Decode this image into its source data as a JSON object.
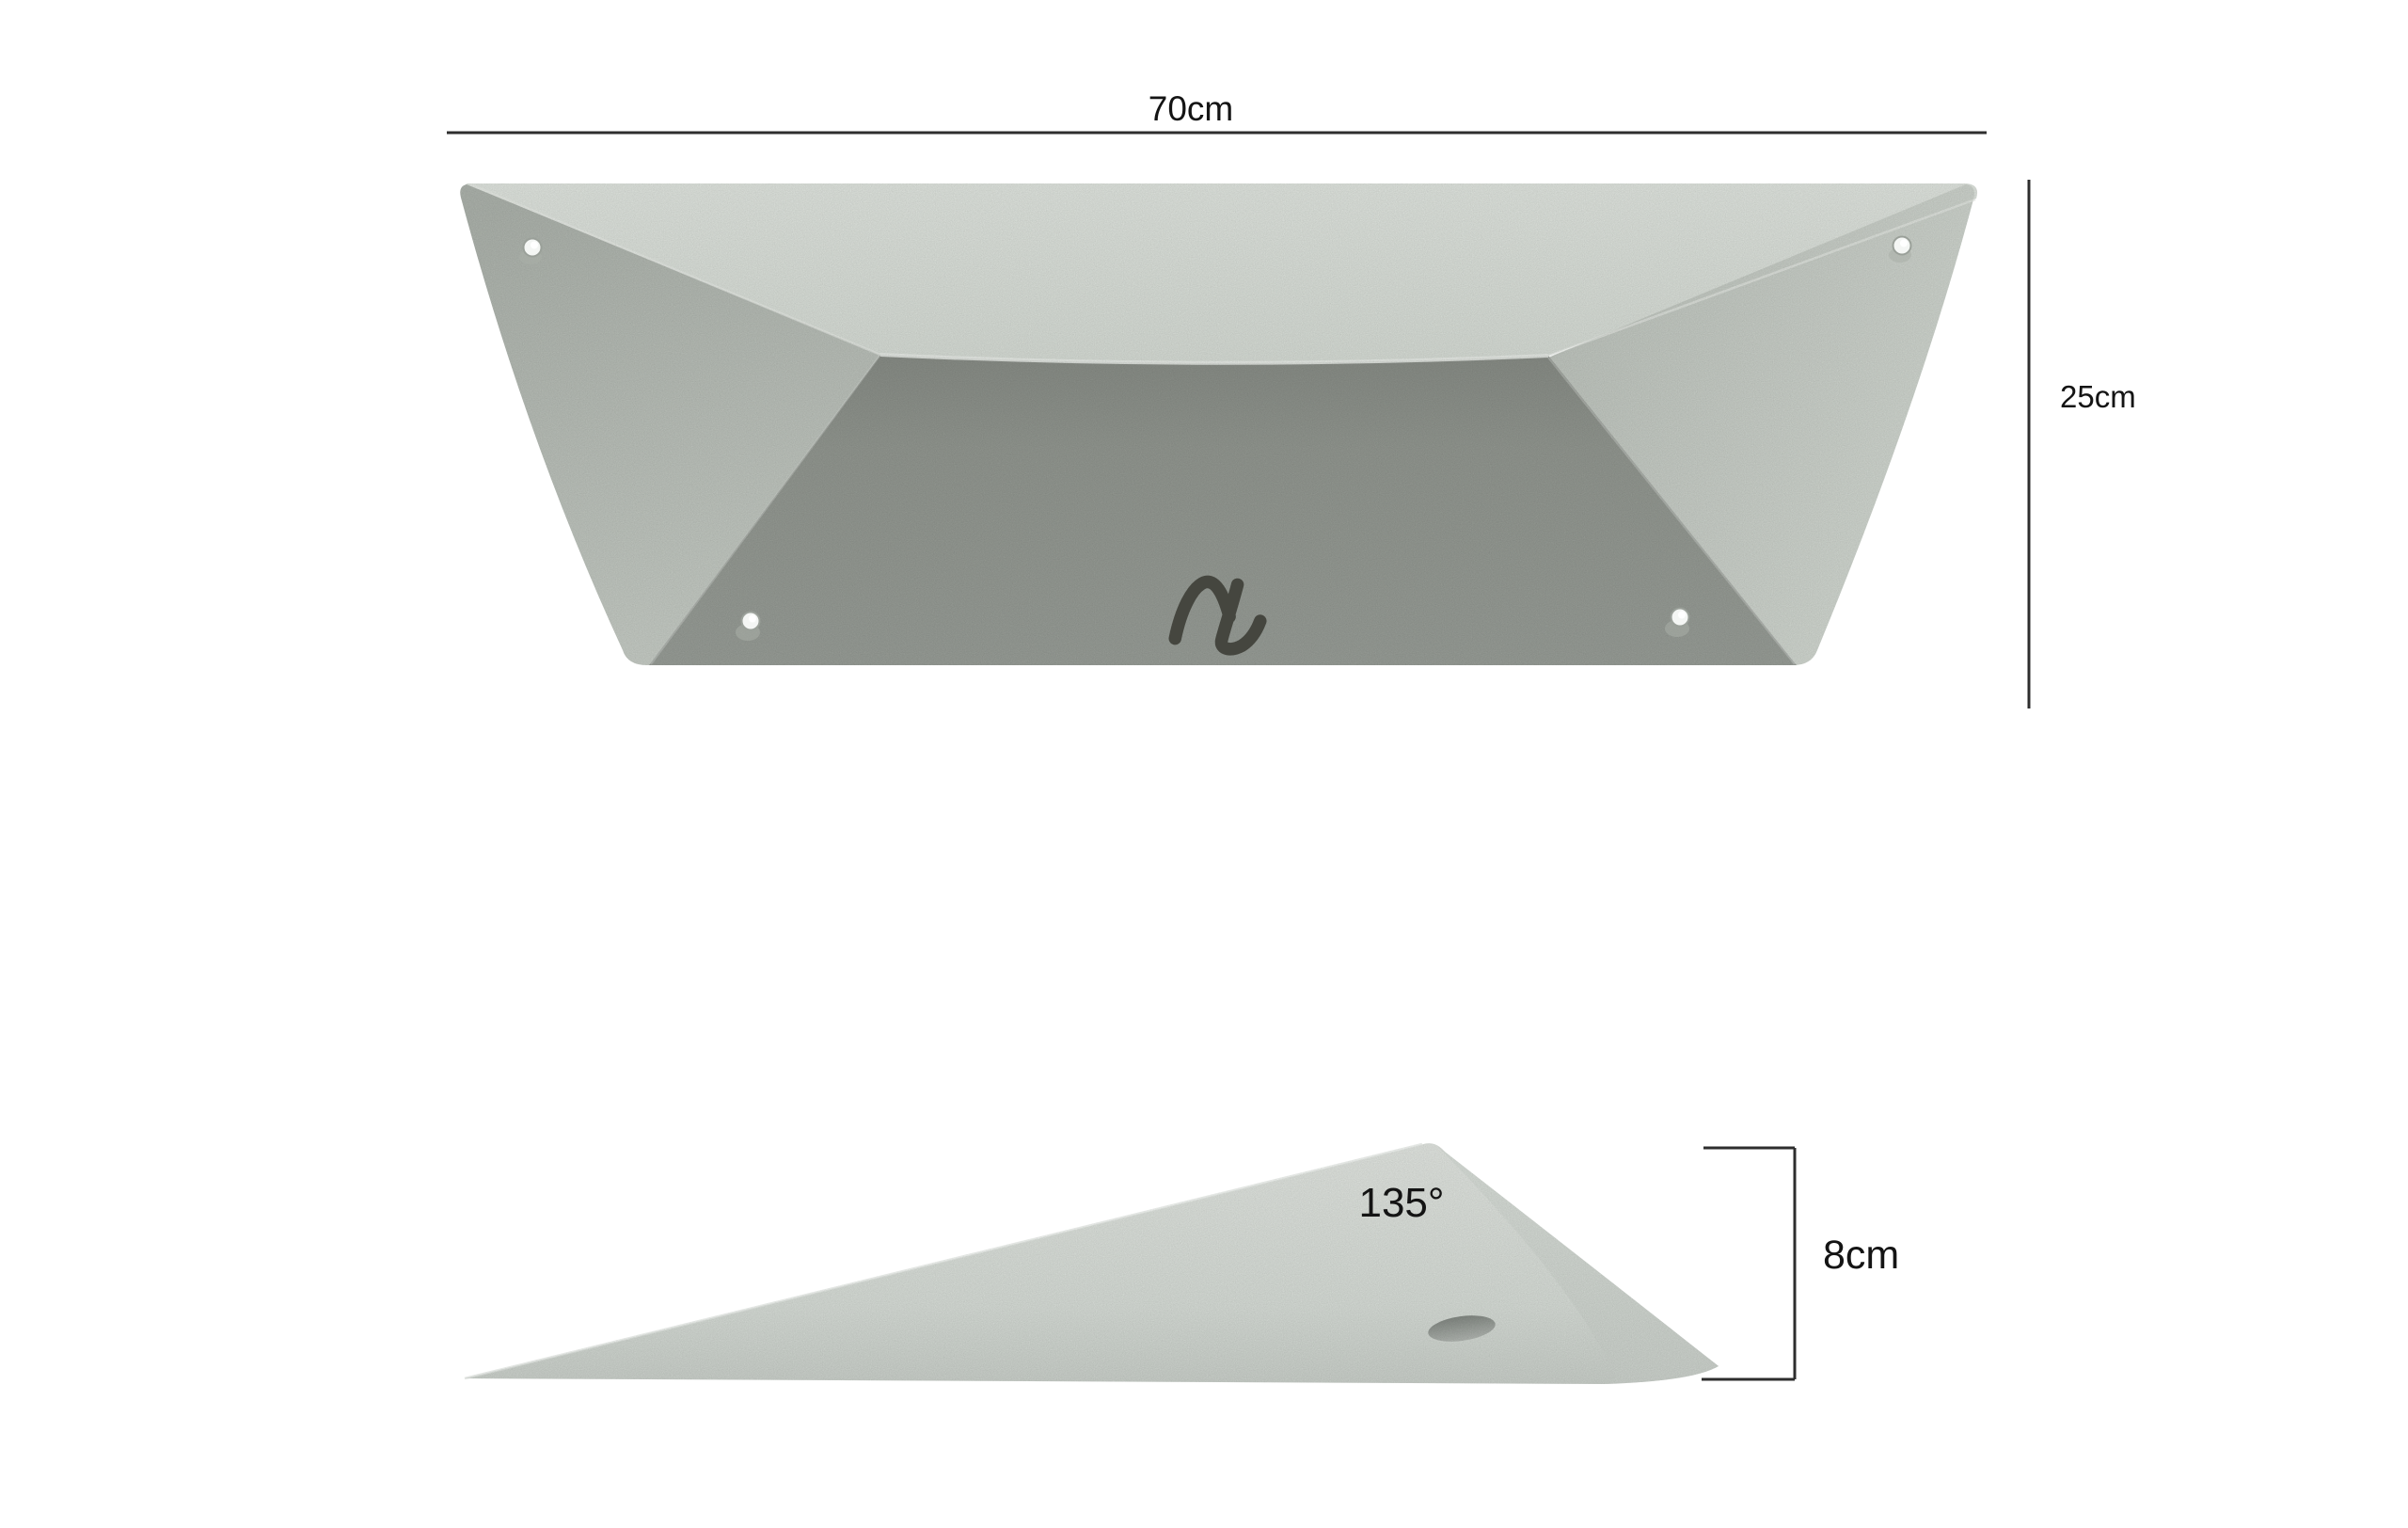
{
  "diagram": {
    "front_view": {
      "width_label": "70cm",
      "height_label": "25cm",
      "screw_hole_count": 4
    },
    "side_view": {
      "angle_label": "135°",
      "thickness_label": "8cm"
    }
  },
  "colors": {
    "background": "#ffffff",
    "dimension_line": "#2e2e2e",
    "label_text": "#141414",
    "top_face_light": "#e6ebe5",
    "top_face_dark": "#dce2db",
    "left_face_dark": "#b2b8b1",
    "left_face_light": "#cdd3cc",
    "right_face_dark": "#c3c9c2",
    "right_face_light": "#dce2db",
    "front_face_dark": "#8c918a",
    "front_face_mid": "#979c95",
    "front_face_light": "#9da29c",
    "fold_highlight": "#f0f3ef",
    "wedge_light": "#e8ece7",
    "wedge_mid": "#dde3dd",
    "wedge_shadow": "#d0d6d0",
    "facet_light": "#e0e6e0",
    "facet_dark": "#d2d8d2",
    "hole_fill": "#f4f6f4",
    "hole_rim": "#9aa099",
    "hole_shadow": "#a9afa8",
    "oval_dark": "#878d87",
    "oval_light": "#b7bcb7",
    "logo": "#45463f"
  },
  "icons": {
    "brand_logo": "brand-squiggle-logo"
  }
}
